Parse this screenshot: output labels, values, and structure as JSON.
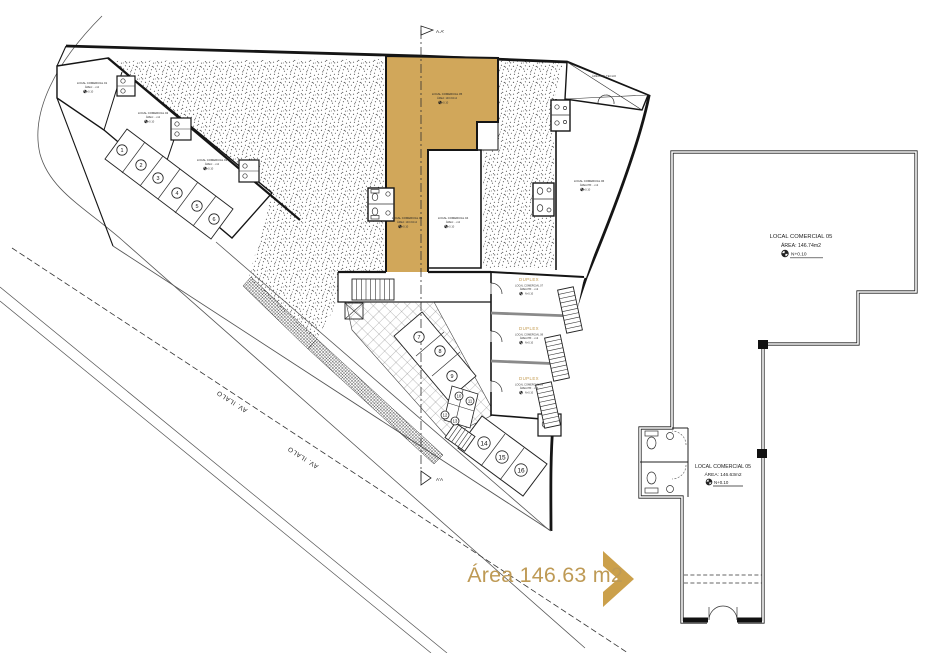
{
  "colors": {
    "gold_fill": "#D1A75A",
    "gold_accent": "#C39A4F",
    "chevron_gold": "#CBA04B",
    "caption_gold": "#BE9A55",
    "ink": "#1b1b1b"
  },
  "caption": {
    "text": "Área 146.63 m2"
  },
  "street": {
    "labels": [
      "AV. ILALO",
      "AV. ILALO"
    ]
  },
  "main_plan": {
    "section": {
      "top_label": "A.A'",
      "bottom_label": "A'A"
    },
    "void_label": "ÁREA SIN TECHO",
    "level_value": "N+0.10",
    "units": {
      "u01": {
        "name": "LOCAL COMERCIAL 01",
        "area": "ÁREA: ...m2"
      },
      "u02": {
        "name": "LOCAL COMERCIAL 02",
        "area": "ÁREA: ...m2"
      },
      "u03": {
        "name": "LOCAL COMERCIAL 03",
        "area": "ÁREA: ...m2"
      },
      "u04": {
        "name": "LOCAL COMERCIAL 04",
        "area": "ÁREA: ...m2"
      },
      "u05": {
        "name": "LOCAL COMERCIAL 05",
        "area": "ÁREA: 146.63m2"
      },
      "u06": {
        "name": "LOCAL COMERCIAL 06",
        "area": "ÁREA PB: ...m2"
      }
    },
    "duplex": [
      {
        "title": "DUPLEX",
        "name": "LOCAL COMERCIAL 07",
        "area": "ÁREA PB: ...m2"
      },
      {
        "title": "DUPLEX",
        "name": "LOCAL COMERCIAL 08",
        "area": "ÁREA PB: ...m2"
      },
      {
        "title": "DUPLEX",
        "name": "LOCAL COMERCIAL 09",
        "area": "ÁREA PB: ...m2"
      }
    ],
    "stalls": [
      {
        "n": "1",
        "x": 122,
        "y": 150
      },
      {
        "n": "2",
        "x": 141,
        "y": 165
      },
      {
        "n": "3",
        "x": 158,
        "y": 178
      },
      {
        "n": "4",
        "x": 177,
        "y": 193
      },
      {
        "n": "5",
        "x": 197,
        "y": 206
      },
      {
        "n": "6",
        "x": 214,
        "y": 219
      },
      {
        "n": "7",
        "x": 419,
        "y": 337
      },
      {
        "n": "8",
        "x": 440,
        "y": 351
      },
      {
        "n": "9",
        "x": 452,
        "y": 376
      },
      {
        "n": "10",
        "x": 459,
        "y": 396
      },
      {
        "n": "11",
        "x": 470,
        "y": 401
      },
      {
        "n": "12",
        "x": 445,
        "y": 415
      },
      {
        "n": "13",
        "x": 455,
        "y": 421
      },
      {
        "n": "14",
        "x": 484,
        "y": 443
      },
      {
        "n": "15",
        "x": 502,
        "y": 457
      },
      {
        "n": "16",
        "x": 521,
        "y": 470
      }
    ]
  },
  "detail_plan": {
    "upper": {
      "name": "LOCAL COMERCIAL 05",
      "area": "ÁREA: 146.74m2",
      "level": "N+0.10"
    },
    "lower": {
      "name": "LOCAL COMERCIAL 05",
      "area": "ÁREA: 146.63m2",
      "level": "N+0.10"
    }
  }
}
